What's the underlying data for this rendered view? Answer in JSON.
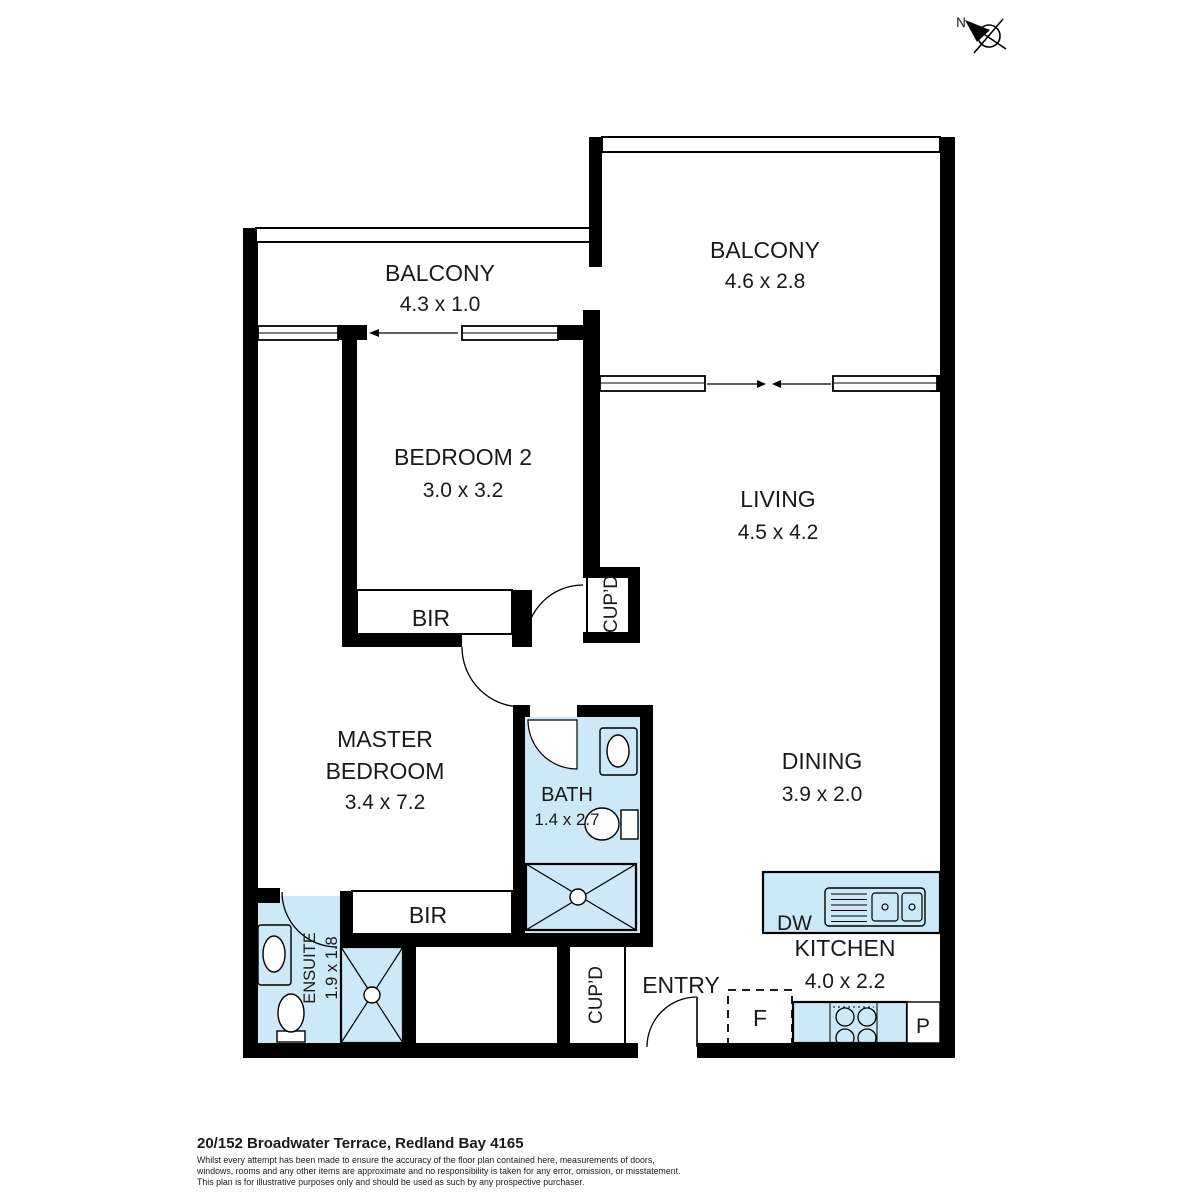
{
  "title": "Floor plan",
  "compass": {
    "north": "N"
  },
  "rooms": {
    "balcony1": {
      "name": "BALCONY",
      "dims": "4.3 x 1.0"
    },
    "balcony2": {
      "name": "BALCONY",
      "dims": "4.6 x 2.8"
    },
    "bedroom2": {
      "name": "BEDROOM 2",
      "dims": "3.0 x 3.2"
    },
    "living": {
      "name": "LIVING",
      "dims": "4.5 x 4.2"
    },
    "master": {
      "line1": "MASTER",
      "line2": "BEDROOM",
      "dims": "3.4 x 7.2"
    },
    "bath": {
      "name": "BATH",
      "dims": "1.4 x 2.7"
    },
    "dining": {
      "name": "DINING",
      "dims": "3.9 x 2.0"
    },
    "kitchen": {
      "name": "KITCHEN",
      "dims": "4.0 x 2.2"
    },
    "ensuite": {
      "name": "ENSUITE",
      "dims": "1.9 x 1.8"
    },
    "entry": {
      "name": "ENTRY"
    }
  },
  "fixtures": {
    "bir_bedroom2": "BIR",
    "bir_master": "BIR",
    "cupboard_upper": "CUP’D",
    "cupboard_lower": "CUP’D",
    "dishwasher": "DW",
    "fridge": "F",
    "pantry": "P"
  },
  "footer": {
    "address": "20/152 Broadwater Terrace, Redland Bay 4165",
    "disclaimer_line1": "Whilst every attempt has been made to ensure the accuracy of the floor plan contained here, measurements of doors,",
    "disclaimer_line2": "windows, rooms and any other items are approximate and no responsibility is taken for any error, omission, or misstatement.",
    "disclaimer_line3": "This plan is for illustrative purposes only and should be used as such by any prospective purchaser."
  },
  "colors": {
    "wall": "#000000",
    "wet_area": "#cde8f7",
    "background": "#ffffff"
  }
}
